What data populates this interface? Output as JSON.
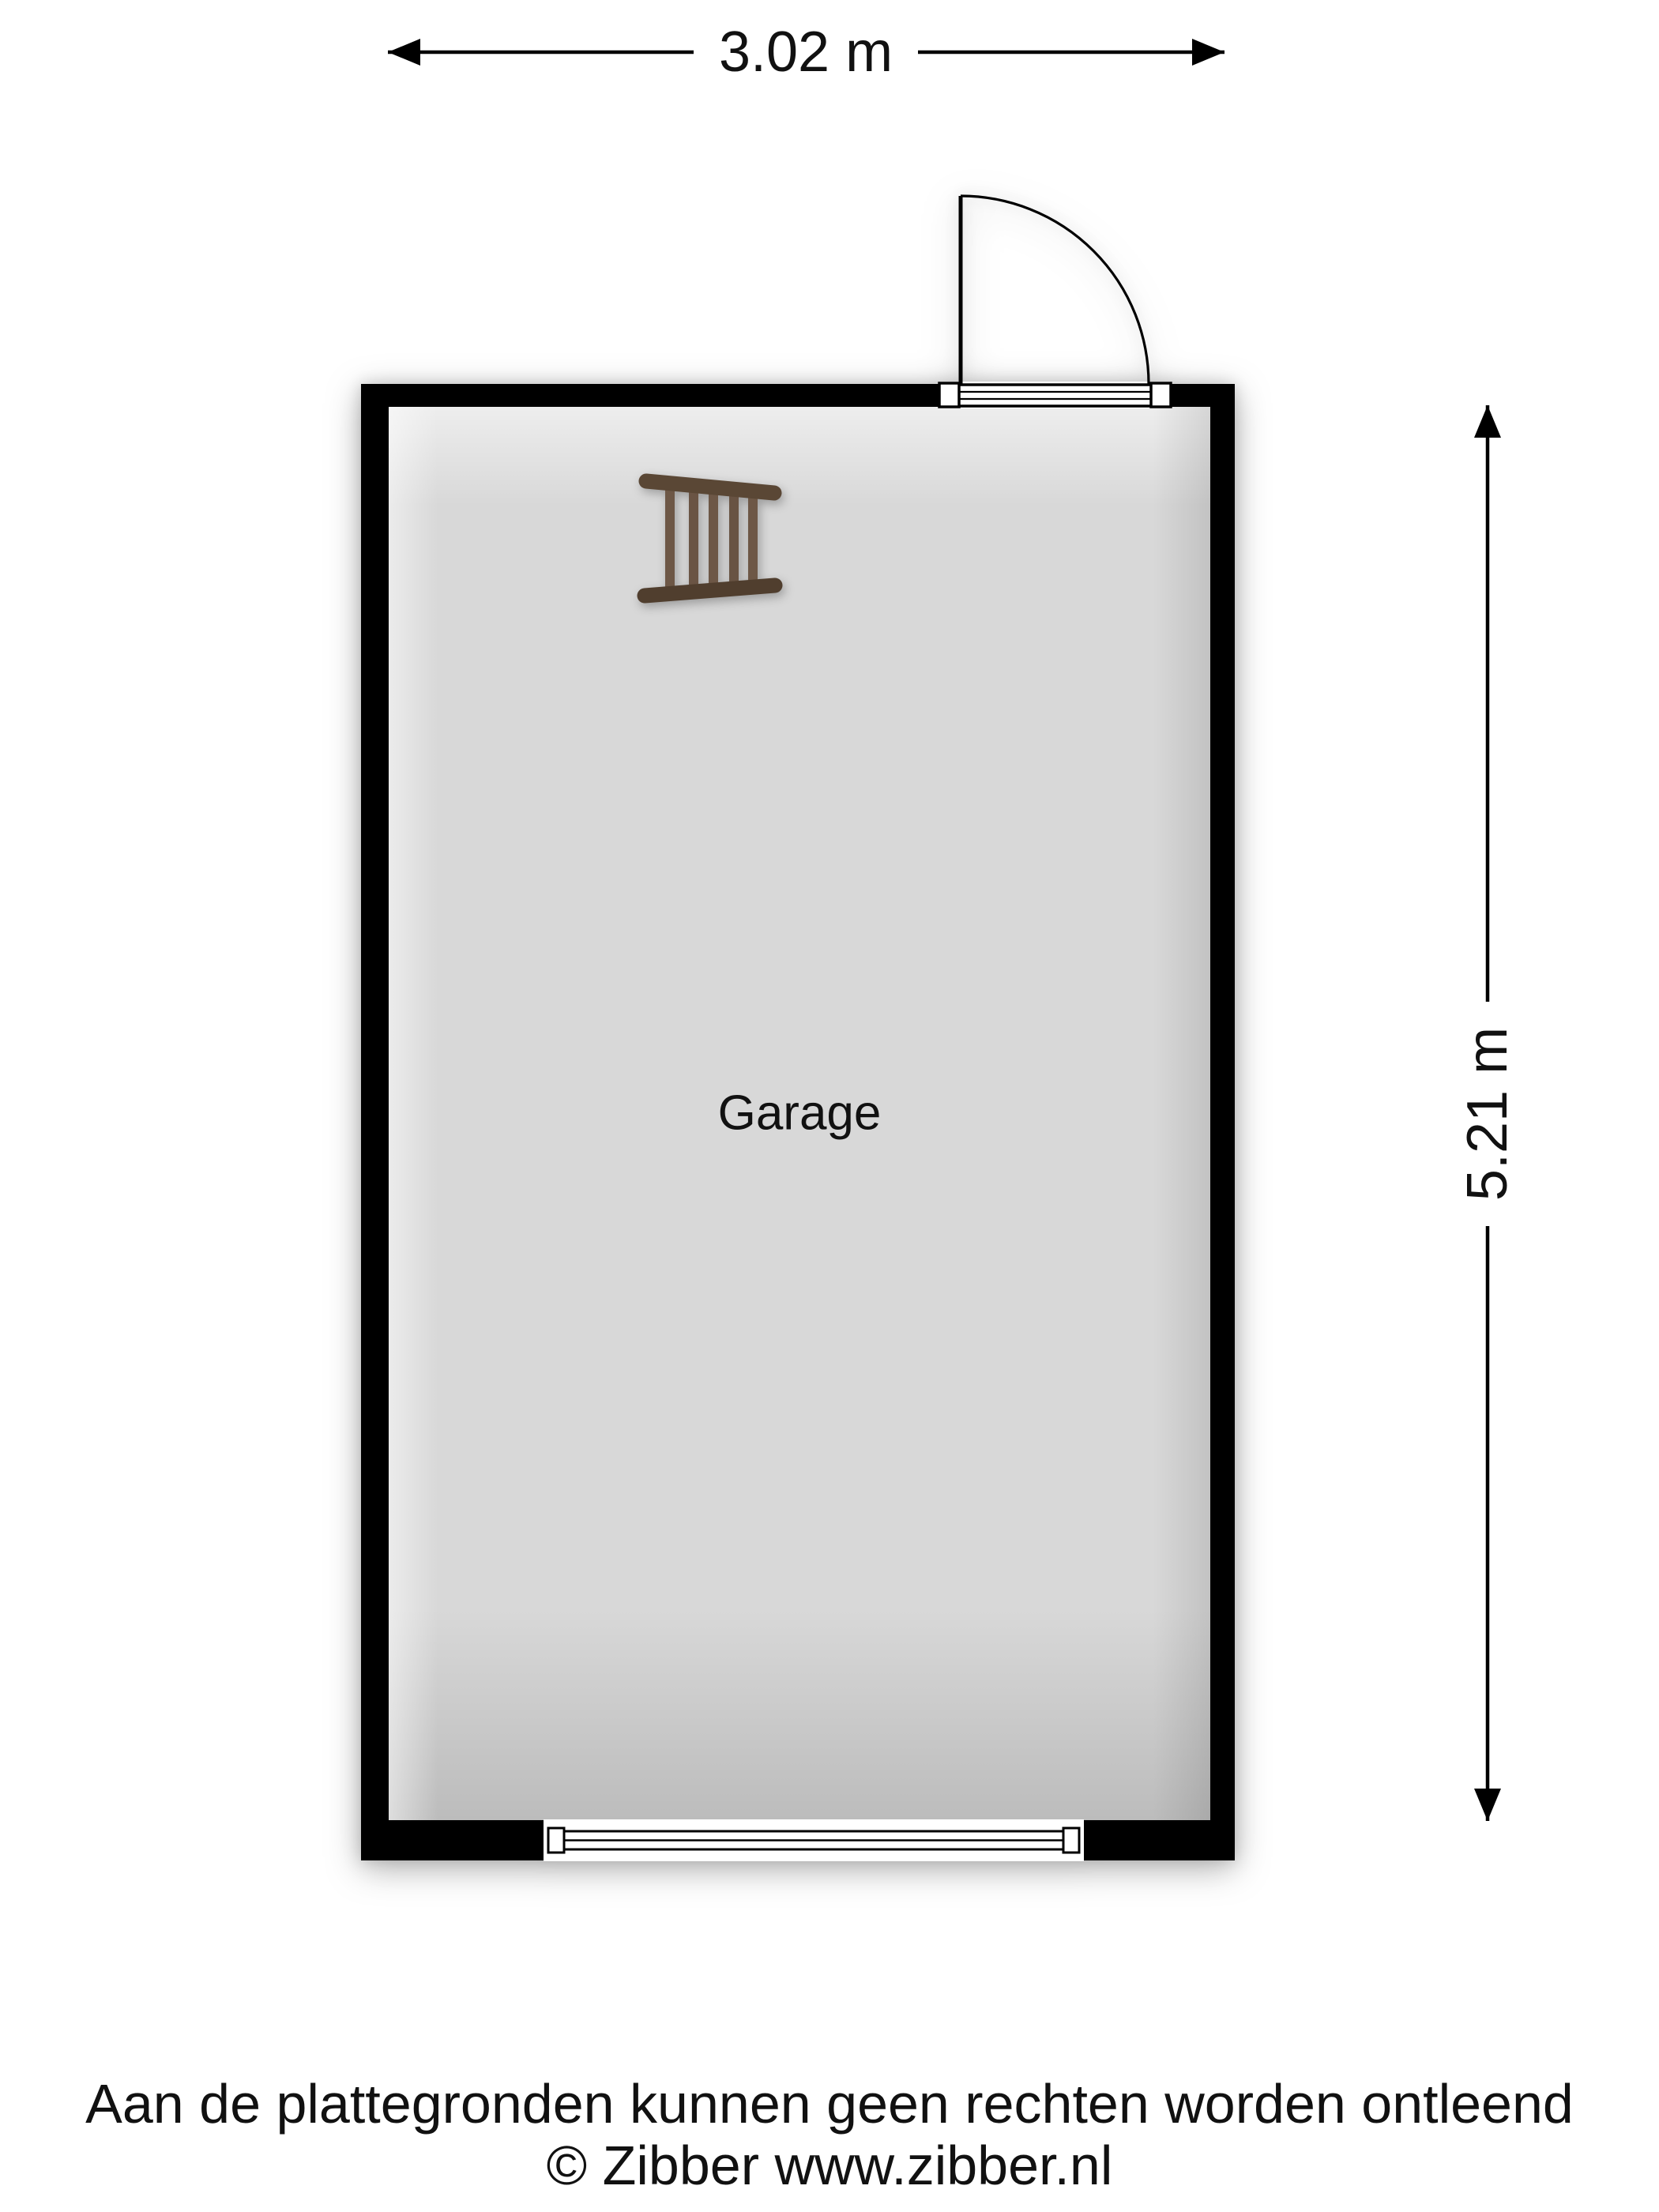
{
  "plan": {
    "room": {
      "label": "Garage"
    },
    "dimensions": {
      "width_label": "3.02 m",
      "height_label": "5.21 m"
    },
    "fixtures": {
      "door": "hinged-door-top-wall",
      "window": "window-bottom-wall",
      "ladder": "wooden-ladder"
    }
  },
  "footer": {
    "disclaimer": "Aan de plattegronden kunnen geen rechten worden ontleend",
    "copyright": "© Zibber www.zibber.nl"
  },
  "colors": {
    "wall": "#000000",
    "floor": "#d8d8d8",
    "ladder_rail_top": "#5a4735",
    "ladder_rail_bottom": "#503e2e",
    "ladder_rung": "#6d5746",
    "text": "#111111"
  }
}
